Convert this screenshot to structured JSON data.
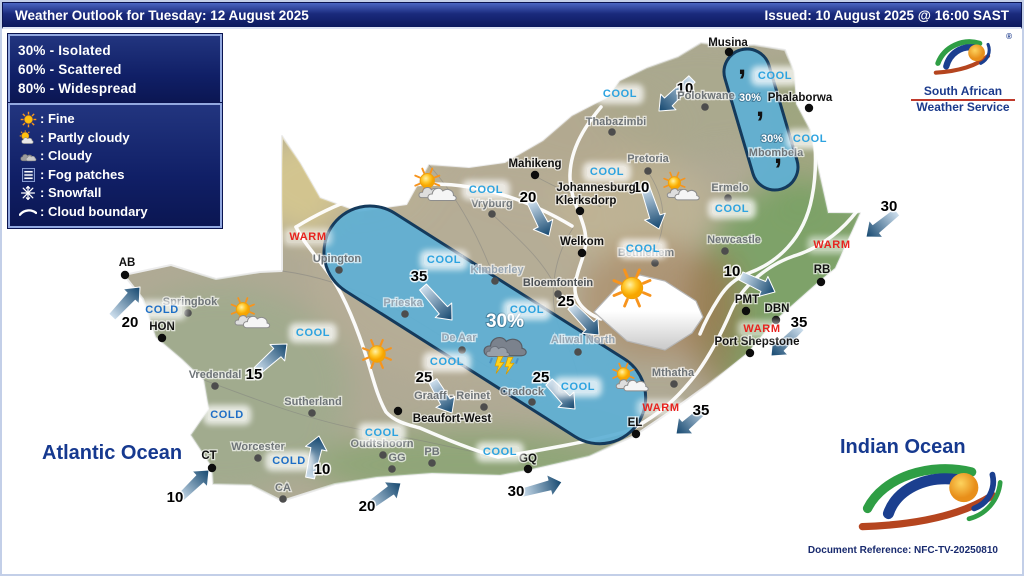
{
  "header": {
    "title": "Weather Outlook for Tuesday: 12 August 2025",
    "issued": "Issued: 10 August 2025 @ 16:00 SAST"
  },
  "legend_probability": {
    "items": [
      "30% - Isolated",
      "60% - Scattered",
      "80% - Widespread"
    ]
  },
  "legend_symbols": {
    "items": [
      {
        "icon": "sun-icon",
        "label": ": Fine"
      },
      {
        "icon": "partly-cloudy-icon",
        "label": ": Partly cloudy"
      },
      {
        "icon": "cloudy-icon",
        "label": ": Cloudy"
      },
      {
        "icon": "fog-icon",
        "label": ": Fog patches"
      },
      {
        "icon": "snowflake-icon",
        "label": ": Snowfall"
      },
      {
        "icon": "cloud-boundary-icon",
        "label": ": Cloud boundary"
      }
    ]
  },
  "logo": {
    "line1": "South African",
    "line2": "Weather Service",
    "registered": "®"
  },
  "oceans": {
    "atlantic": "Atlantic Ocean",
    "indian": "Indian Ocean"
  },
  "document_reference": "Document Reference: NFC-TV-20250810",
  "colors": {
    "cool": "#2da3e0",
    "cold": "#1d6ec6",
    "warm": "#e8231f",
    "navy": "#16398f",
    "band_fill": "#5fafd4",
    "band_stroke": "#143a5c",
    "arrow_dark": "#13466e",
    "arrow_light": "#cfe0ee"
  },
  "map": {
    "cities": [
      {
        "name": "Musina",
        "lx": 728,
        "ly": 42,
        "dx": 729,
        "dy": 52,
        "style": "b"
      },
      {
        "name": "Thabazimbi",
        "lx": 616,
        "ly": 121,
        "dx": 612,
        "dy": 132,
        "style": "g"
      },
      {
        "name": "Polokwane",
        "lx": 706,
        "ly": 95,
        "dx": 705,
        "dy": 107,
        "style": "g"
      },
      {
        "name": "Phalaborwa",
        "lx": 800,
        "ly": 97,
        "dx": 809,
        "dy": 108,
        "style": "b"
      },
      {
        "name": "Mahikeng",
        "lx": 535,
        "ly": 163,
        "dx": 535,
        "dy": 175,
        "style": "b"
      },
      {
        "name": "Pretoria",
        "lx": 648,
        "ly": 158,
        "dx": 648,
        "dy": 171,
        "style": "g"
      },
      {
        "name": "Johannesburg",
        "lx": 596,
        "ly": 187,
        "style": "b"
      },
      {
        "name": "Klerksdorp",
        "lx": 586,
        "ly": 200,
        "dx": 580,
        "dy": 211,
        "style": "b"
      },
      {
        "name": "Vryburg",
        "lx": 492,
        "ly": 203,
        "dx": 492,
        "dy": 214,
        "style": "g"
      },
      {
        "name": "Welkom",
        "lx": 582,
        "ly": 241,
        "dx": 582,
        "dy": 253,
        "style": "b"
      },
      {
        "name": "Bethlehem",
        "lx": 646,
        "ly": 252,
        "dx": 655,
        "dy": 263,
        "style": "g"
      },
      {
        "name": "Ermelo",
        "lx": 730,
        "ly": 187,
        "dx": 728,
        "dy": 198,
        "style": "g"
      },
      {
        "name": "Mbombela",
        "lx": 776,
        "ly": 152,
        "style": "g"
      },
      {
        "name": "Newcastle",
        "lx": 734,
        "ly": 239,
        "dx": 725,
        "dy": 251,
        "style": "g"
      },
      {
        "name": "Upington",
        "lx": 337,
        "ly": 258,
        "dx": 339,
        "dy": 270,
        "style": "g"
      },
      {
        "name": "Kimberley",
        "lx": 497,
        "ly": 269,
        "dx": 495,
        "dy": 281,
        "style": "l"
      },
      {
        "name": "Bloemfontein",
        "lx": 558,
        "ly": 282,
        "dx": 558,
        "dy": 294,
        "style": "d"
      },
      {
        "name": "Prieska",
        "lx": 403,
        "ly": 302,
        "dx": 405,
        "dy": 314,
        "style": "l"
      },
      {
        "name": "De Aar",
        "lx": 459,
        "ly": 337,
        "dx": 462,
        "dy": 350,
        "style": "l"
      },
      {
        "name": "Aliwal North",
        "lx": 583,
        "ly": 339,
        "dx": 578,
        "dy": 352,
        "style": "l"
      },
      {
        "name": "Springbok",
        "lx": 190,
        "ly": 301,
        "dx": 188,
        "dy": 313,
        "style": "g"
      },
      {
        "name": "AB",
        "lx": 127,
        "ly": 262,
        "dx": 125,
        "dy": 275,
        "style": "b"
      },
      {
        "name": "HON",
        "lx": 162,
        "ly": 326,
        "dx": 162,
        "dy": 338,
        "style": "b"
      },
      {
        "name": "Vredendal",
        "lx": 215,
        "ly": 374,
        "dx": 215,
        "dy": 386,
        "style": "g"
      },
      {
        "name": "Sutherland",
        "lx": 313,
        "ly": 401,
        "dx": 312,
        "dy": 413,
        "style": "g"
      },
      {
        "name": "Worcester",
        "lx": 258,
        "ly": 446,
        "dx": 258,
        "dy": 458,
        "style": "g"
      },
      {
        "name": "CT",
        "lx": 209,
        "ly": 455,
        "dx": 212,
        "dy": 468,
        "style": "b"
      },
      {
        "name": "CA",
        "lx": 283,
        "ly": 487,
        "dx": 283,
        "dy": 499,
        "style": "g"
      },
      {
        "name": "Oudtshoorn",
        "lx": 382,
        "ly": 443,
        "dx": 383,
        "dy": 455,
        "style": "g"
      },
      {
        "name": "GG",
        "lx": 397,
        "ly": 457,
        "dx": 392,
        "dy": 469,
        "style": "g"
      },
      {
        "name": "PB",
        "lx": 432,
        "ly": 451,
        "dx": 432,
        "dy": 463,
        "style": "g"
      },
      {
        "name": "Beaufort-West",
        "lx": 452,
        "ly": 418,
        "dx": 398,
        "dy": 411,
        "style": "b"
      },
      {
        "name": "Graaff - Reinet",
        "lx": 452,
        "ly": 395,
        "dx": 484,
        "dy": 407,
        "style": "g"
      },
      {
        "name": "Cradock",
        "lx": 522,
        "ly": 391,
        "dx": 532,
        "dy": 402,
        "style": "g"
      },
      {
        "name": "Mthatha",
        "lx": 673,
        "ly": 372,
        "dx": 674,
        "dy": 384,
        "style": "g"
      },
      {
        "name": "EL",
        "lx": 635,
        "ly": 422,
        "dx": 636,
        "dy": 434,
        "style": "b"
      },
      {
        "name": "GQ",
        "lx": 528,
        "ly": 458,
        "dx": 528,
        "dy": 469,
        "style": "b"
      },
      {
        "name": "Port Shepstone",
        "lx": 757,
        "ly": 341,
        "dx": 750,
        "dy": 353,
        "style": "b"
      },
      {
        "name": "PMT",
        "lx": 747,
        "ly": 299,
        "dx": 746,
        "dy": 311,
        "style": "b"
      },
      {
        "name": "DBN",
        "lx": 777,
        "ly": 308,
        "dx": 776,
        "dy": 320,
        "style": "b"
      },
      {
        "name": "RB",
        "lx": 822,
        "ly": 269,
        "dx": 821,
        "dy": 282,
        "style": "b"
      }
    ],
    "zone_labels": [
      {
        "text": "COOL",
        "type": "cool",
        "x": 620,
        "y": 94
      },
      {
        "text": "COOL",
        "type": "cool",
        "x": 775,
        "y": 76
      },
      {
        "text": "COOL",
        "type": "cool",
        "x": 810,
        "y": 139
      },
      {
        "text": "COOL",
        "type": "cool",
        "x": 607,
        "y": 172
      },
      {
        "text": "COOL",
        "type": "cool",
        "x": 732,
        "y": 209
      },
      {
        "text": "COOL",
        "type": "cool",
        "x": 486,
        "y": 190
      },
      {
        "text": "COOL",
        "type": "cool",
        "x": 643,
        "y": 249
      },
      {
        "text": "COOL",
        "type": "cool",
        "x": 444,
        "y": 260
      },
      {
        "text": "COOL",
        "type": "cool",
        "x": 527,
        "y": 310
      },
      {
        "text": "COOL",
        "type": "cool",
        "x": 313,
        "y": 333
      },
      {
        "text": "COOL",
        "type": "cool",
        "x": 447,
        "y": 362
      },
      {
        "text": "COOL",
        "type": "cool",
        "x": 578,
        "y": 387
      },
      {
        "text": "COOL",
        "type": "cool",
        "x": 382,
        "y": 433
      },
      {
        "text": "COOL",
        "type": "cool",
        "x": 500,
        "y": 452
      },
      {
        "text": "COLD",
        "type": "cold",
        "x": 162,
        "y": 310
      },
      {
        "text": "COLD",
        "type": "cold",
        "x": 227,
        "y": 415
      },
      {
        "text": "COLD",
        "type": "cold",
        "x": 289,
        "y": 461
      },
      {
        "text": "WARM",
        "type": "warm",
        "x": 308,
        "y": 237
      },
      {
        "text": "WARM",
        "type": "warm",
        "x": 832,
        "y": 245
      },
      {
        "text": "WARM",
        "type": "warm",
        "x": 762,
        "y": 329
      },
      {
        "text": "WARM",
        "type": "warm",
        "x": 661,
        "y": 408
      }
    ],
    "wind_arrows": [
      {
        "label": "10",
        "lx": 685,
        "ly": 88,
        "x1": 692,
        "y1": 79,
        "x2": 659,
        "y2": 111
      },
      {
        "label": "30",
        "lx": 889,
        "ly": 206,
        "x1": 897,
        "y1": 212,
        "x2": 866,
        "y2": 237
      },
      {
        "label": "10",
        "lx": 641,
        "ly": 187,
        "x1": 645,
        "y1": 187,
        "x2": 659,
        "y2": 229
      },
      {
        "label": "20",
        "lx": 528,
        "ly": 197,
        "x1": 531,
        "y1": 201,
        "x2": 549,
        "y2": 236
      },
      {
        "label": "10",
        "lx": 732,
        "ly": 271,
        "x1": 741,
        "y1": 276,
        "x2": 775,
        "y2": 292
      },
      {
        "label": "35",
        "lx": 799,
        "ly": 322,
        "x1": 801,
        "y1": 327,
        "x2": 771,
        "y2": 356
      },
      {
        "label": "35",
        "lx": 701,
        "ly": 410,
        "x1": 707,
        "y1": 407,
        "x2": 676,
        "y2": 434
      },
      {
        "label": "25",
        "lx": 566,
        "ly": 301,
        "x1": 571,
        "y1": 306,
        "x2": 599,
        "y2": 335
      },
      {
        "label": "35",
        "lx": 419,
        "ly": 276,
        "x1": 423,
        "y1": 287,
        "x2": 452,
        "y2": 320
      },
      {
        "label": "25",
        "lx": 424,
        "ly": 377,
        "x1": 433,
        "y1": 381,
        "x2": 452,
        "y2": 413
      },
      {
        "label": "25",
        "lx": 541,
        "ly": 377,
        "x1": 549,
        "y1": 382,
        "x2": 575,
        "y2": 409
      },
      {
        "label": "20",
        "lx": 130,
        "ly": 322,
        "x1": 112,
        "y1": 317,
        "x2": 140,
        "y2": 287
      },
      {
        "label": "15",
        "lx": 254,
        "ly": 374,
        "x1": 257,
        "y1": 371,
        "x2": 287,
        "y2": 344
      },
      {
        "label": "10",
        "lx": 175,
        "ly": 497,
        "x1": 179,
        "y1": 499,
        "x2": 209,
        "y2": 470
      },
      {
        "label": "10",
        "lx": 322,
        "ly": 469,
        "x1": 310,
        "y1": 478,
        "x2": 319,
        "y2": 436
      },
      {
        "label": "20",
        "lx": 367,
        "ly": 506,
        "x1": 365,
        "y1": 509,
        "x2": 401,
        "y2": 483
      },
      {
        "label": "30",
        "lx": 516,
        "ly": 491,
        "x1": 521,
        "y1": 493,
        "x2": 562,
        "y2": 482
      }
    ],
    "weather_icons": [
      {
        "type": "partly-cloudy-icon",
        "x": 435,
        "y": 189,
        "s": 14
      },
      {
        "type": "partly-cloudy-icon",
        "x": 250,
        "y": 317,
        "s": 13
      },
      {
        "type": "partly-cloudy-icon",
        "x": 681,
        "y": 190,
        "s": 12
      },
      {
        "type": "partly-cloudy-icon",
        "x": 630,
        "y": 381,
        "s": 12
      },
      {
        "type": "sun-icon",
        "x": 377,
        "y": 354,
        "s": 10
      },
      {
        "type": "sun-icon",
        "x": 632,
        "y": 288,
        "s": 13
      },
      {
        "type": "thunderstorm-icon",
        "x": 504,
        "y": 349,
        "s": 15
      }
    ],
    "rain_percent_labels": [
      {
        "text": "30%",
        "x": 750,
        "y": 101,
        "size": 11
      },
      {
        "text": "30%",
        "x": 772,
        "y": 142,
        "size": 11
      },
      {
        "text": "30%",
        "x": 505,
        "y": 327,
        "size": 19
      }
    ],
    "drizzle_marks": [
      {
        "x": 742,
        "y": 74
      },
      {
        "x": 760,
        "y": 116
      },
      {
        "x": 778,
        "y": 163
      }
    ]
  }
}
